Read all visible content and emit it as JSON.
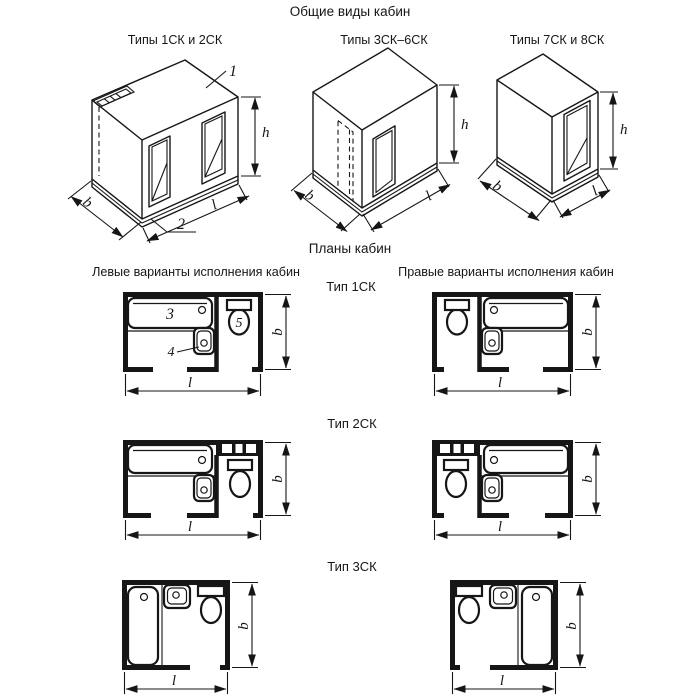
{
  "page": {
    "background": "#ffffff",
    "line_color": "#161616"
  },
  "general_views": {
    "heading": "Общие виды кабин",
    "items": [
      {
        "label": "Типы 1СК и 2СК"
      },
      {
        "label": "Типы 3СК–6СК"
      },
      {
        "label": "Типы 7СК и 8СК"
      }
    ]
  },
  "plans": {
    "heading": "Планы кабин",
    "left_heading": "Левые варианты исполнения кабин",
    "right_heading": "Правые варианты исполнения кабин",
    "types": [
      {
        "label": "Тип 1СК"
      },
      {
        "label": "Тип 2СК"
      },
      {
        "label": "Тип 3СК"
      }
    ]
  },
  "dimensions": {
    "height": "h",
    "width": "b",
    "length": "l"
  },
  "callouts": [
    {
      "number": "1"
    },
    {
      "number": "2"
    },
    {
      "number": "3"
    },
    {
      "number": "4"
    },
    {
      "number": "5"
    }
  ]
}
